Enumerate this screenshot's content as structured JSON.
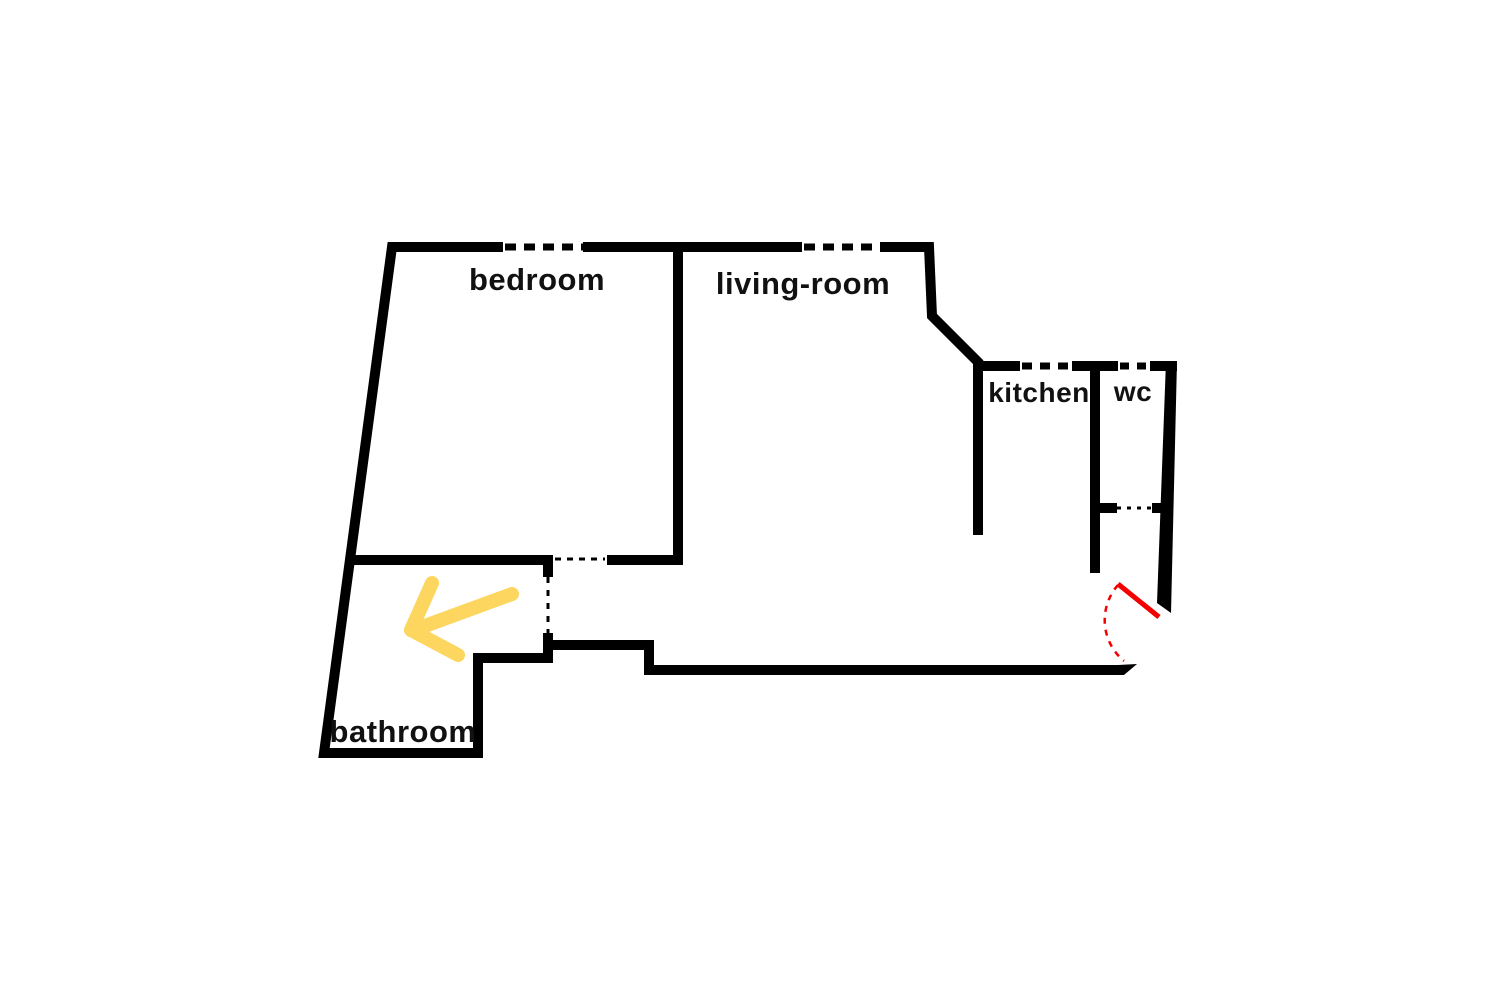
{
  "floorplan": {
    "rooms": [
      {
        "id": "bedroom",
        "label": "bedroom"
      },
      {
        "id": "living_room",
        "label": "living-room"
      },
      {
        "id": "kitchen",
        "label": "kitchen"
      },
      {
        "id": "wc",
        "label": "wc"
      },
      {
        "id": "bathroom",
        "label": "bathroom"
      }
    ],
    "colors": {
      "background": "#ffffff",
      "wall": "#000000",
      "label": "#111111",
      "entrance_door": "#f50000",
      "highlight_arrow": "#fcd65e"
    }
  }
}
